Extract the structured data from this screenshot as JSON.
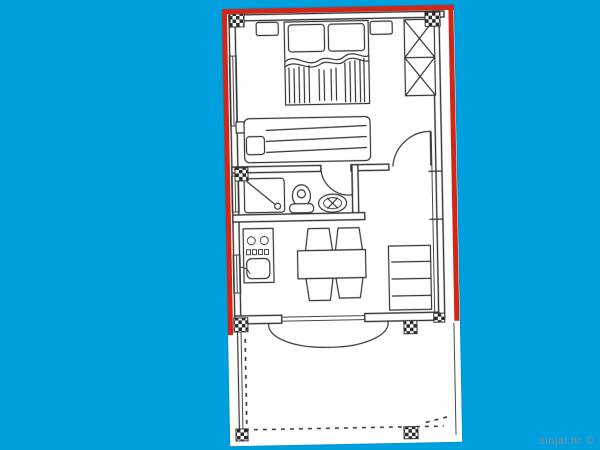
{
  "colors": {
    "bg": "#00A0DF",
    "paper": "#FFFFFF",
    "ink": "#333333",
    "red": "#D22718",
    "wm": "#7D8D98"
  },
  "watermark": {
    "text": "sinjal.hr ©"
  },
  "plan": {
    "type": "apartment-floor-plan",
    "boundary_highlight_color": "#D22718",
    "features": [
      "double-bed",
      "nightstands",
      "wardrobe",
      "sofa-daybed",
      "bedroom-door",
      "shower",
      "toilet",
      "wash-basin",
      "bathroom-door",
      "kitchen-counter",
      "stove-burners",
      "kitchen-sink",
      "dining-table",
      "four-chairs",
      "shelf-cabinet",
      "french-doors-to-terrace",
      "terrace-dashed-outline",
      "column-markers",
      "windows"
    ]
  }
}
